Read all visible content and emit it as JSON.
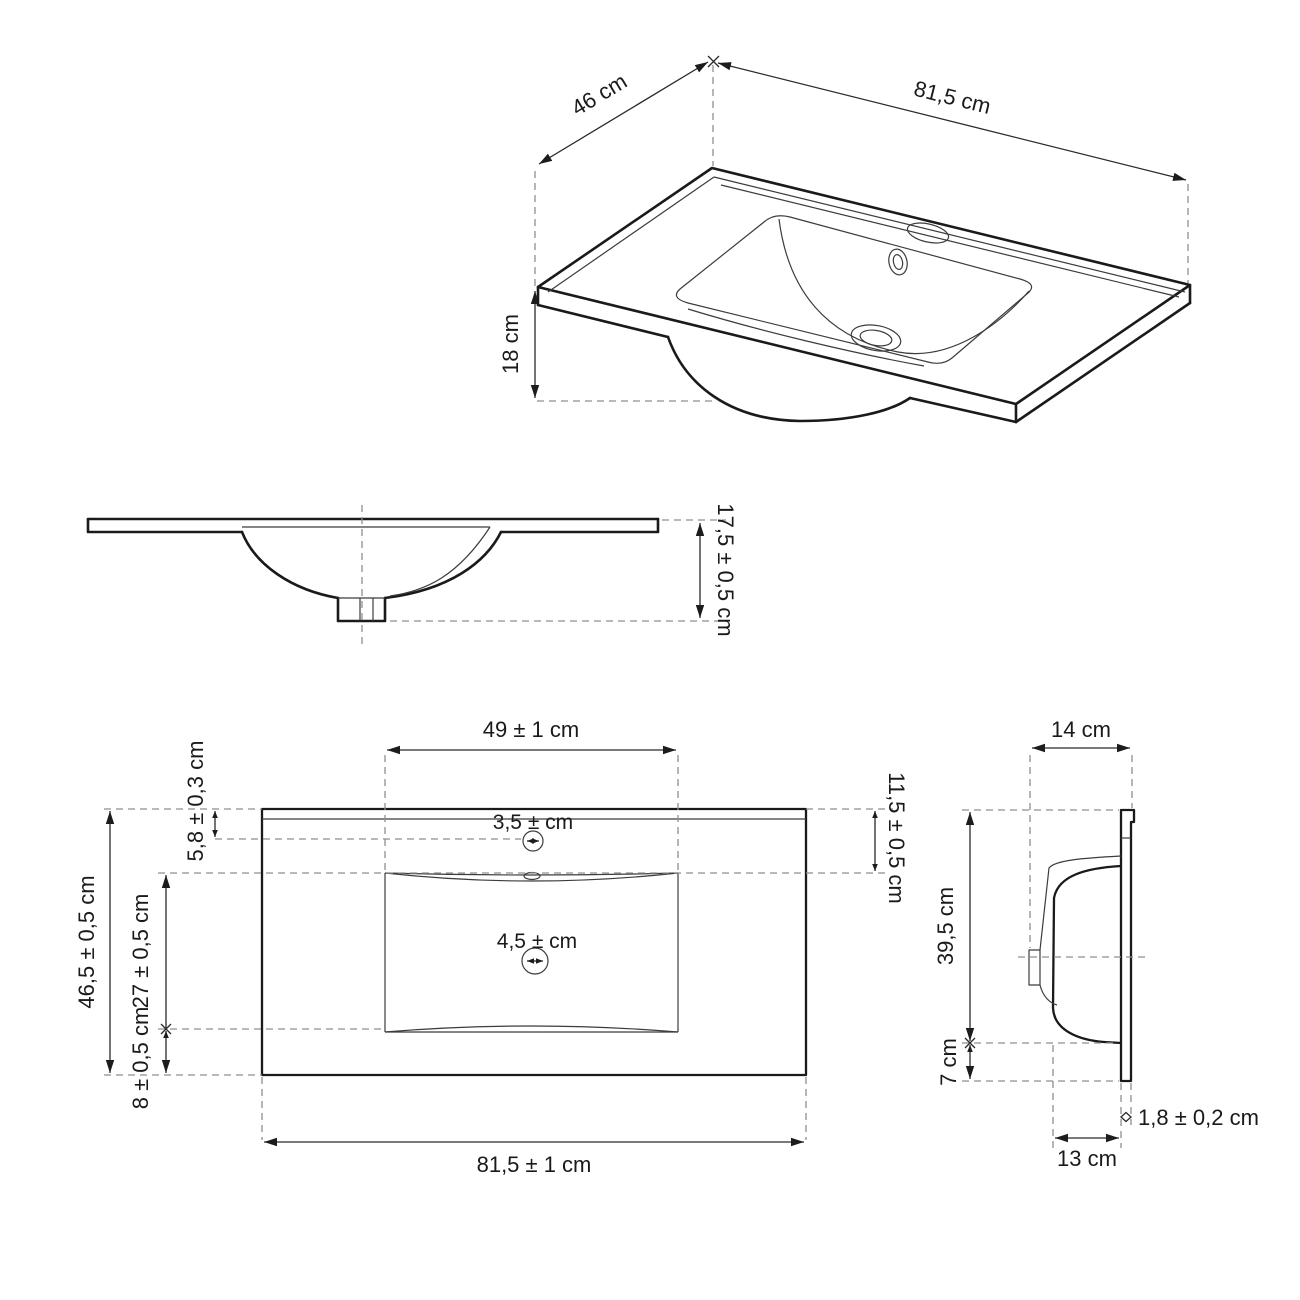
{
  "diagram": {
    "type": "technical-drawing",
    "subject": "vanity washbasin dimensional drawing",
    "line_color": "#1a1a1a",
    "dash_color": "#8f8f8f",
    "background": "#ffffff",
    "views": {
      "isometric": {
        "label": "isometric view",
        "dim_depth": "46 cm",
        "dim_width": "81,5 cm",
        "dim_height": "18 cm"
      },
      "front_section": {
        "label": "front section view",
        "dim_total_height": "17,5 ± 0,5 cm"
      },
      "plan": {
        "label": "top plan view",
        "dim_basin_width": "49 ± 1 cm",
        "dim_faucet_setback": "5,8 ± 0,3 cm",
        "dim_total_depth": "46,5 ± 0,5 cm",
        "dim_basin_depth": "27 ± 0,5 cm",
        "dim_front_margin": "8 ± 0,5 cm",
        "dim_back_margin": "11,5 ± 0,5 cm",
        "dim_faucet_hole": "3,5 ± cm",
        "dim_drain_hole": "4,5 ± cm",
        "dim_total_width": "81,5 ± 1 cm"
      },
      "side_section": {
        "label": "side section view",
        "dim_top_depth": "14 cm",
        "dim_height": "39,5 cm",
        "dim_bottom_height": "7 cm",
        "dim_bottom_depth": "13 cm",
        "dim_thickness": "1,8 ± 0,2 cm"
      }
    }
  }
}
